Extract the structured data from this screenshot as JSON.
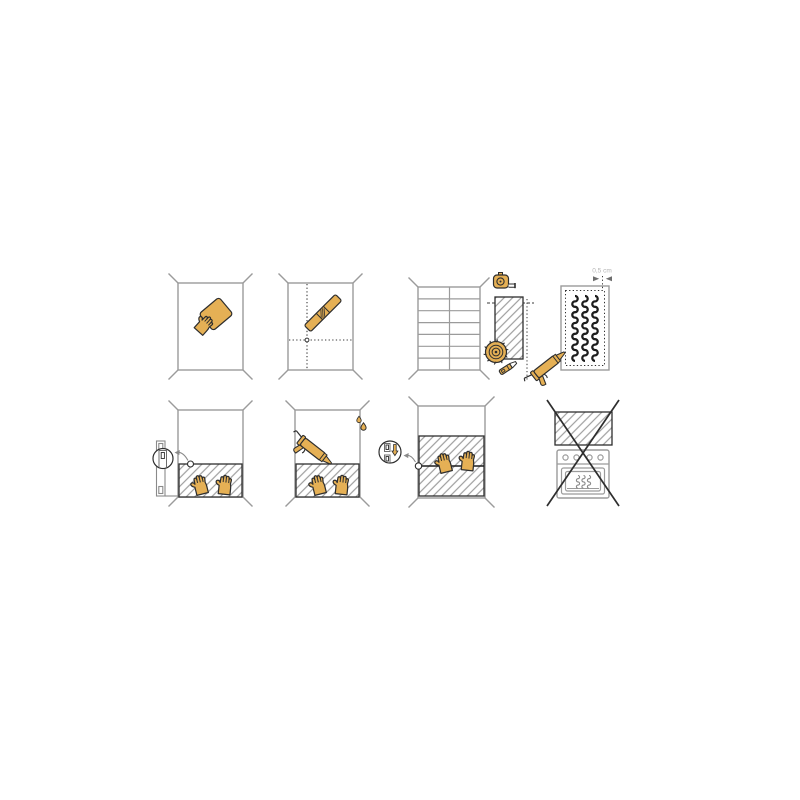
{
  "page": {
    "background_color": "#ffffff",
    "content_type": "wall-panel-installation-pictograms"
  },
  "colors": {
    "accent_yellow": "#e5b055",
    "outline_dark": "#2e2e2e",
    "line_gray": "#9b9b9b",
    "arrow_gray": "#8a8a8a",
    "adhesive_black": "#1d1d1d",
    "label_gray": "#b4b4b4"
  },
  "steps": [
    {
      "name": "clean-wall",
      "icons": [
        "wall-outline",
        "hand-with-sponge-icon"
      ]
    },
    {
      "name": "mark-guide-lines",
      "icons": [
        "wall-outline",
        "dotted-guide-lines",
        "spirit-level-icon"
      ]
    },
    {
      "name": "measure-and-cut",
      "icons": [
        "tiled-wall-grid",
        "measuring-tape-icon",
        "hatched-panel",
        "circular-saw-blade-icon",
        "utility-knife-icon"
      ]
    },
    {
      "name": "apply-adhesive",
      "measurement_label": "0,5 cm",
      "icons": [
        "panel-back",
        "adhesive-bead-lines",
        "caulking-gun-icon",
        "measure-arrows"
      ]
    },
    {
      "name": "set-panel-on-trim",
      "icons": [
        "wall-outline",
        "edge-trim-profile",
        "magnifier-detail-circle",
        "pressing-hands-icon"
      ]
    },
    {
      "name": "seal-top-edge",
      "icons": [
        "wall-outline",
        "caulking-gun-icon",
        "sealant-drops-icon",
        "pressing-hands-icon"
      ]
    },
    {
      "name": "slide-panel-into-joint",
      "icons": [
        "wall-outline",
        "joint-detail-circle",
        "down-arrow-icon",
        "pressing-hands-icon"
      ]
    },
    {
      "name": "no-install-above-stove",
      "icons": [
        "hatched-panel",
        "stove-oven-icon",
        "prohibition-cross-icon"
      ]
    }
  ]
}
